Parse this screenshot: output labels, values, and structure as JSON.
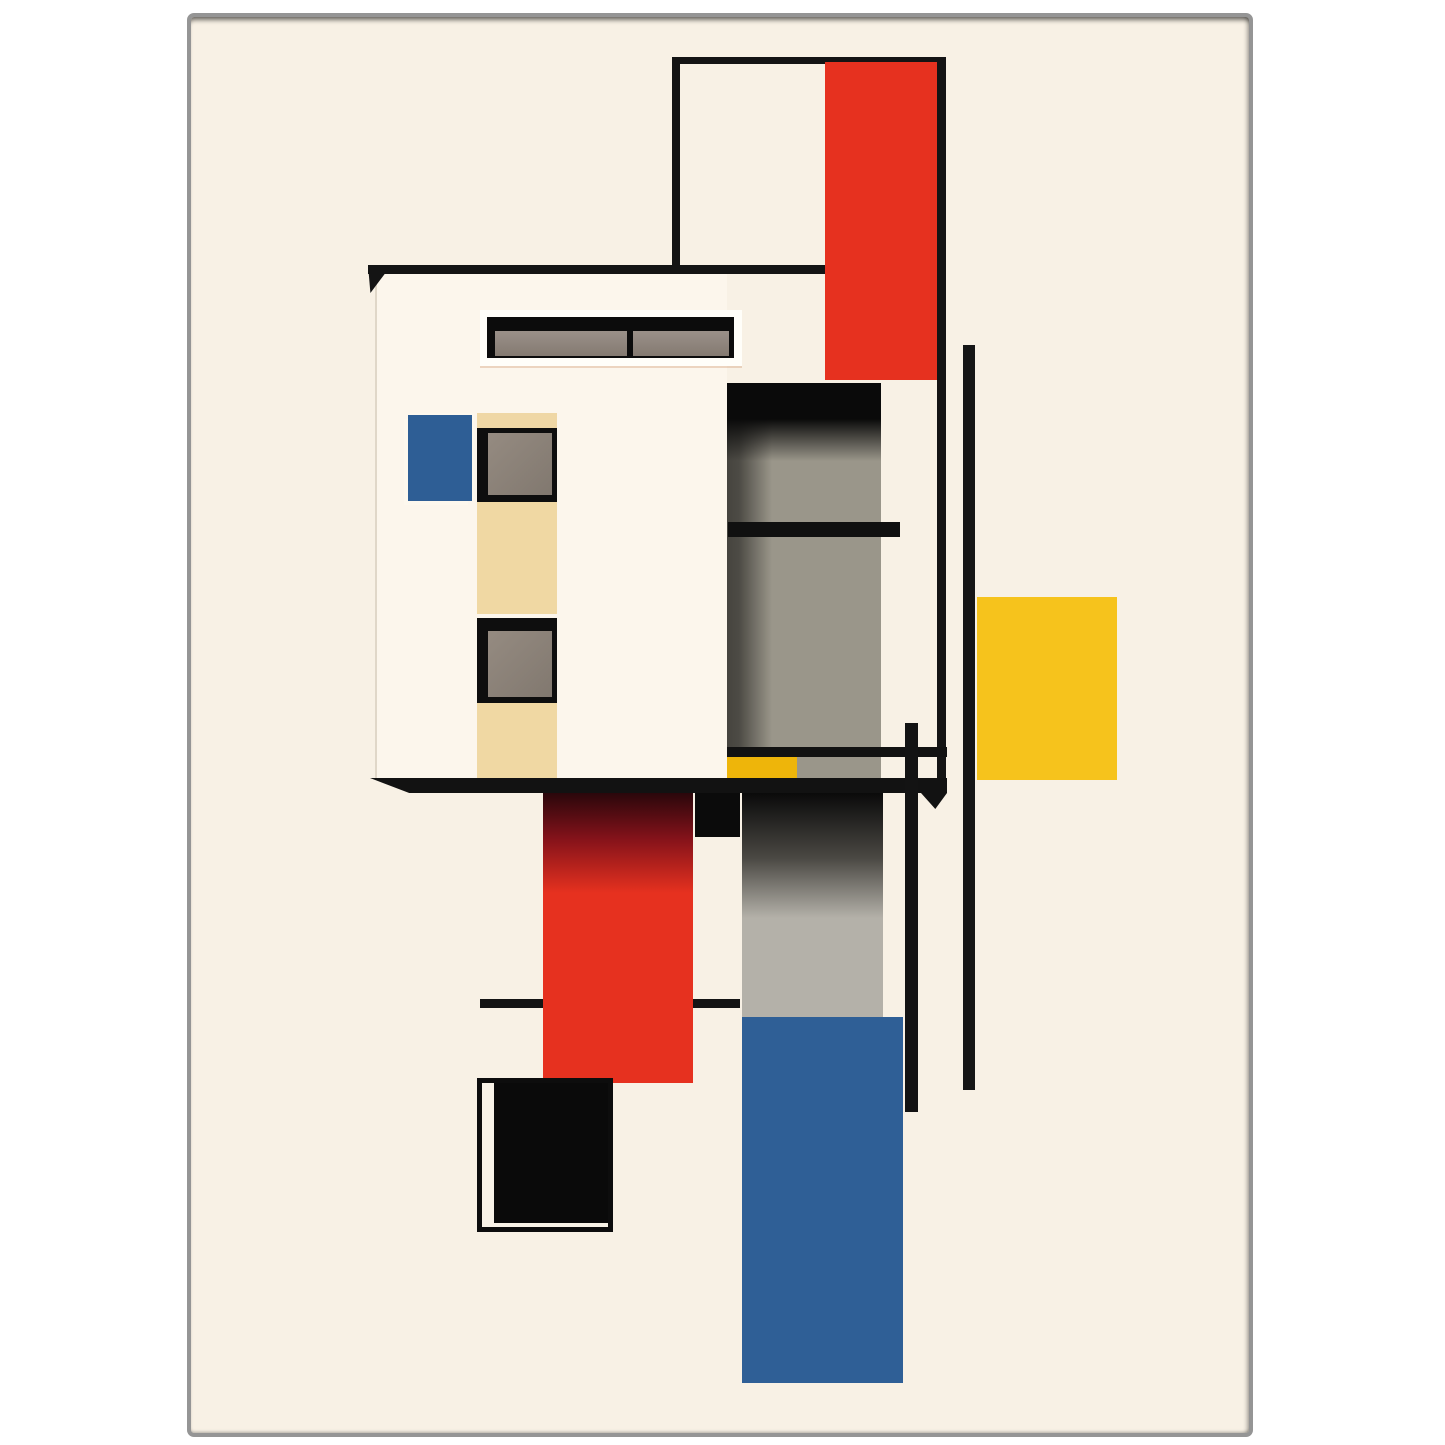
{
  "artwork": {
    "style": "De Stijl / Bauhaus abstract architectural composition poster",
    "canvas": {
      "width": 1445,
      "height": 1445,
      "page_background": "#ffffff"
    },
    "palette": {
      "red": "#e6311f",
      "red_shadow": "#2a070b",
      "blue": "#2e5e96",
      "yellow": "#f6c31c",
      "yellow_deep": "#eeb50a",
      "tan": "#f0d8a3",
      "cream": "#f8f1e5",
      "building_face": "#fcf6ec",
      "frame_white": "#fffef9",
      "gray_panel": "#9a968a",
      "gray_panel_light": "#b4b1a9",
      "gray_pane": "#8e8479",
      "black": "#0e0e0e",
      "poster_frame": "#959595"
    },
    "shapes": [
      {
        "name": "poster-sheet",
        "x": 187,
        "y": 13,
        "w": 1066,
        "h": 1424,
        "bg": "#f8f1e5",
        "border": "4px solid #959595",
        "radius": "7px",
        "shadow": "inset 0 6px 5px -3px rgba(0,0,0,0.55), inset -4px 0 4px -2px rgba(0,0,0,0.3), inset 0 -3px 3px -2px rgba(0,0,0,0.25)"
      },
      {
        "name": "building-face",
        "x": 375,
        "y": 273,
        "w": 352,
        "h": 505,
        "bg": "#fcf6ec",
        "border": "0 solid transparent",
        "shadow": "inset 2px 0 0 0 rgba(190,178,158,0.45)"
      },
      {
        "name": "roof-line",
        "x": 368,
        "y": 265,
        "w": 457,
        "h": 9,
        "bg": "#141414"
      },
      {
        "name": "roof-line-wedge",
        "x": 368,
        "y": 265,
        "w": 30,
        "h": 28,
        "bg": "#141414",
        "clip": "polygon(0 0, 78% 0, 8% 100%)"
      },
      {
        "name": "tower-outline-top",
        "x": 672,
        "y": 57,
        "w": 274,
        "h": 7,
        "bg": "#141414"
      },
      {
        "name": "tower-outline-left",
        "x": 672,
        "y": 57,
        "w": 8,
        "h": 216,
        "bg": "#141414"
      },
      {
        "name": "tower-red-column",
        "x": 825,
        "y": 62,
        "w": 112,
        "h": 318,
        "bg": "#e6311f"
      },
      {
        "name": "tower-outline-right",
        "x": 937,
        "y": 57,
        "w": 9,
        "h": 721,
        "bg": "#141414"
      },
      {
        "name": "clerestory-frame",
        "x": 480,
        "y": 310,
        "w": 262,
        "h": 56,
        "bg": "#fffef9",
        "shadow": "0 2px 0 0 rgba(205,150,110,0.35)"
      },
      {
        "name": "clerestory-glass",
        "x": 487,
        "y": 317,
        "w": 247,
        "h": 41,
        "bg": "#0c0c0c"
      },
      {
        "name": "clerestory-pane-left",
        "x": 495,
        "y": 331,
        "w": 132,
        "h": 25,
        "bg": "linear-gradient(180deg,#9a9089 0%,#847a71 100%)"
      },
      {
        "name": "clerestory-pane-right",
        "x": 633,
        "y": 331,
        "w": 96,
        "h": 25,
        "bg": "linear-gradient(180deg,#9a9089 0%,#847a71 100%)"
      },
      {
        "name": "blue-window",
        "x": 408,
        "y": 415,
        "w": 64,
        "h": 86,
        "bg": "#2e5e95",
        "shadow": "-4px 4px 0 0 #fdf8ee, 2px -2px 0 0 #fdf8ee"
      },
      {
        "name": "window1-tan-header",
        "x": 477,
        "y": 413,
        "w": 80,
        "h": 17,
        "bg": "#efd7a5"
      },
      {
        "name": "window1-frame",
        "x": 477,
        "y": 428,
        "w": 80,
        "h": 74,
        "bg": "#0e0e0e"
      },
      {
        "name": "window1-pane",
        "x": 488,
        "y": 433,
        "w": 64,
        "h": 62,
        "bg": "linear-gradient(135deg,#958b81 0%,#81786f 100%)"
      },
      {
        "name": "tan-column-upper",
        "x": 477,
        "y": 502,
        "w": 80,
        "h": 112,
        "bg": "#f0d8a3"
      },
      {
        "name": "window2-frame",
        "x": 477,
        "y": 618,
        "w": 80,
        "h": 85,
        "bg": "#0e0e0e"
      },
      {
        "name": "window2-pane",
        "x": 488,
        "y": 631,
        "w": 64,
        "h": 66,
        "bg": "linear-gradient(135deg,#958b81 0%,#81786f 100%)"
      },
      {
        "name": "tan-column-lower",
        "x": 477,
        "y": 703,
        "w": 80,
        "h": 75,
        "bg": "#f0d8a3"
      },
      {
        "name": "gray-panel-upper",
        "x": 727,
        "y": 383,
        "w": 154,
        "h": 395,
        "bg": "linear-gradient(180deg,#0a0a0a 0px,#0a0a0a 36px,rgba(10,10,10,0) 78px), linear-gradient(90deg,rgba(0,0,0,0.55) 0px,rgba(0,0,0,0.5) 12px,rgba(0,0,0,0) 45px), #9a968a"
      },
      {
        "name": "gray-panel-shelf",
        "x": 728,
        "y": 522,
        "w": 172,
        "h": 15,
        "bg": "#101010"
      },
      {
        "name": "gallery-rail",
        "x": 727,
        "y": 747,
        "w": 220,
        "h": 10,
        "bg": "#121212"
      },
      {
        "name": "yellow-ledge",
        "x": 727,
        "y": 757,
        "w": 70,
        "h": 21,
        "bg": "#eeb50a"
      },
      {
        "name": "lower-cross-line",
        "x": 480,
        "y": 999,
        "w": 260,
        "h": 9,
        "bg": "#141414"
      },
      {
        "name": "red-column-lower",
        "x": 543,
        "y": 793,
        "w": 150,
        "h": 290,
        "bg": "linear-gradient(180deg,#2a070b 0px,#83121a 45px,#e6311f 100px,#e6311f 100%)"
      },
      {
        "name": "black-block",
        "x": 695,
        "y": 793,
        "w": 45,
        "h": 44,
        "bg": "#0b0b0b"
      },
      {
        "name": "gray-panel-lower",
        "x": 742,
        "y": 793,
        "w": 141,
        "h": 224,
        "bg": "linear-gradient(180deg,#0a0a0a 0px,#4a4843 65px,#b4b1a9 125px,#b4b1a9 100%)"
      },
      {
        "name": "blue-column",
        "x": 742,
        "y": 1017,
        "w": 161,
        "h": 366,
        "bg": "#2f5f96"
      },
      {
        "name": "balcony-slab",
        "x": 370,
        "y": 778,
        "w": 577,
        "h": 15,
        "bg": "#121212",
        "clip": "polygon(0 0, 100% 0, 100% 100%, 6.8% 100%)"
      },
      {
        "name": "balcony-slab-tip",
        "x": 921,
        "y": 793,
        "w": 26,
        "h": 16,
        "bg": "#121212",
        "clip": "polygon(0 0, 100% 0, 55% 100%)"
      },
      {
        "name": "vertical-post",
        "x": 905,
        "y": 723,
        "w": 13,
        "h": 389,
        "bg": "#131313"
      },
      {
        "name": "yellow-square",
        "x": 977,
        "y": 597,
        "w": 140,
        "h": 183,
        "bg": "#f6c31c"
      },
      {
        "name": "tall-thin-line",
        "x": 963,
        "y": 345,
        "w": 12,
        "h": 745,
        "bg": "#161616"
      },
      {
        "name": "open-box-frame",
        "x": 477,
        "y": 1078,
        "w": 136,
        "h": 154,
        "bg": "#f8f2e7",
        "border": "5px solid #0d0d0d"
      },
      {
        "name": "open-box-fill",
        "x": 494,
        "y": 1083,
        "w": 114,
        "h": 140,
        "bg": "#0a0a0a"
      }
    ]
  }
}
